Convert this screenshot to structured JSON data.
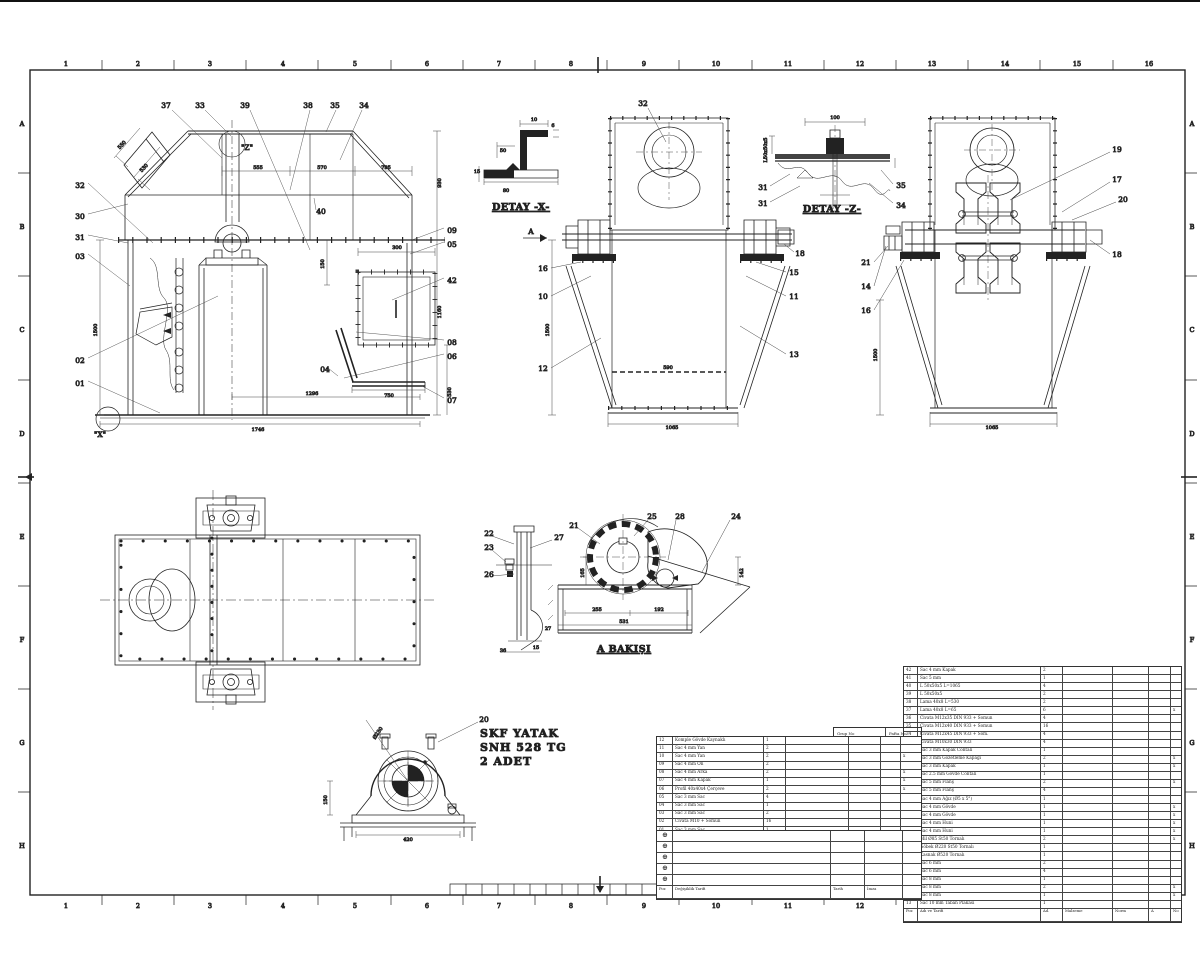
{
  "border": {
    "cols": [
      "1",
      "2",
      "3",
      "4",
      "5",
      "6",
      "7",
      "8",
      "9",
      "10",
      "11",
      "12",
      "13",
      "14",
      "15",
      "16"
    ],
    "rows": [
      "A",
      "B",
      "C",
      "D",
      "E",
      "F",
      "G",
      "H"
    ]
  },
  "titles": {
    "detay_x": "DETAY -X-",
    "detay_z": "DETAY -Z-",
    "a_bakisi": "A BAKIŞI",
    "label_z": "\"Z\"",
    "label_x": "\"X\"",
    "label_a": "A"
  },
  "callouts": {
    "front_top": [
      "37",
      "33",
      "39",
      "38",
      "35",
      "34"
    ],
    "front_left": [
      "32",
      "30",
      "31",
      "03",
      "02",
      "01"
    ],
    "front_right": [
      "09",
      "05",
      "42",
      "08",
      "06",
      "07"
    ],
    "front_mid": [
      "40",
      "04"
    ],
    "mid_view": [
      "32",
      "16",
      "10",
      "12",
      "15",
      "11",
      "13",
      "18"
    ],
    "right_view": [
      "19",
      "17",
      "20",
      "18",
      "21",
      "14",
      "16"
    ],
    "detay_z": [
      "31",
      "31",
      "35",
      "34"
    ],
    "a_bakisi": [
      "22",
      "23",
      "26",
      "27",
      "21",
      "25",
      "28",
      "24"
    ],
    "bearing": [
      "20"
    ]
  },
  "dims": {
    "front": {
      "w1": "555",
      "w2": "570",
      "w3": "795",
      "htop": "930",
      "hleft": "1500",
      "door": "300",
      "hright": "1160",
      "hboot": "530",
      "chute": "750",
      "base1": "1296",
      "base2": "1746",
      "inc1": "550",
      "inc2": "530",
      "v1": "150"
    },
    "mid": {
      "h": "1500",
      "inner": "590",
      "base": "1065"
    },
    "right": {
      "h": "1500",
      "base": "1065"
    },
    "detay_x": {
      "d1": "10",
      "d2": "6",
      "d3": "50",
      "d4": "15",
      "d5": "80"
    },
    "detay_z": {
      "d1": "100",
      "d2": "L50x50x5"
    },
    "a_bakisi": {
      "v1": "165",
      "v2": "142",
      "w1": "255",
      "w2": "192",
      "w3": "531",
      "s1": "27",
      "s2": "15",
      "s3": "36"
    },
    "bearing": {
      "h": "150",
      "w": "420",
      "dia": "Ø230"
    }
  },
  "bearing_note": {
    "l1": "SKF YATAK",
    "l2": "SNH 528 TG",
    "l3": "2 ADET"
  },
  "bom_right": {
    "header": [
      "Poz",
      "Adı ve Tarifi",
      "Ad.",
      "Malzeme",
      "Norm",
      "A",
      "No"
    ],
    "rows": [
      {
        "p": "42",
        "d": "Sac 4 mm Kapak",
        "q": "2",
        "n": ""
      },
      {
        "p": "41",
        "d": "Sac 5 mm",
        "q": "1",
        "n": ""
      },
      {
        "p": "40",
        "d": "L 50x50x5  L=1065",
        "q": "4",
        "n": ""
      },
      {
        "p": "39",
        "d": "L 50x50x5",
        "q": "2",
        "n": ""
      },
      {
        "p": "38",
        "d": "Lama 40x8  L=530",
        "q": "2",
        "n": ""
      },
      {
        "p": "37",
        "d": "Lama 40x8  L=65",
        "q": "6",
        "n": "x"
      },
      {
        "p": "36",
        "d": "Civata M12x35 DIN 933 + Somun",
        "q": "4",
        "n": ""
      },
      {
        "p": "35",
        "d": "Civata M12x40 DIN 933 + Somun",
        "q": "16",
        "n": ""
      },
      {
        "p": "34",
        "d": "Civata M12x45 DIN 933 + Som.",
        "q": "4",
        "n": ""
      },
      {
        "p": "33",
        "d": "Civata M10x30 DIN 933",
        "q": "4",
        "n": ""
      },
      {
        "p": "32",
        "d": "Sac 3 mm  Kapak Contalı",
        "q": "1",
        "n": ""
      },
      {
        "p": "31",
        "d": "Sac 3 mm  Gözetleme Kapağı",
        "q": "2",
        "n": "x"
      },
      {
        "p": "30",
        "d": "Sac 3 mm  Kapak",
        "q": "1",
        "n": "x"
      },
      {
        "p": "29",
        "d": "Sac 2.5 mm  Gövde Contalı",
        "q": "1",
        "n": ""
      },
      {
        "p": "28",
        "d": "Sac 5 mm  Flanş",
        "q": "2",
        "n": "x"
      },
      {
        "p": "27",
        "d": "Sac 5 mm  Flanş",
        "q": "4",
        "n": ""
      },
      {
        "p": "26",
        "d": "Sac 4 mm  Ağız  (Ø5 x 5°)",
        "q": "1",
        "n": ""
      },
      {
        "p": "25",
        "d": "Sac 4 mm  Gövde",
        "q": "1",
        "n": "x"
      },
      {
        "p": "24",
        "d": "Sac 4 mm  Gövde",
        "q": "1",
        "n": "x"
      },
      {
        "p": "23",
        "d": "Sac 4 mm  Huni",
        "q": "1",
        "n": "x"
      },
      {
        "p": "22",
        "d": "Sac 4 mm  Huni",
        "q": "1",
        "n": "x"
      },
      {
        "p": "21",
        "d": "Mil Ø85  St50  Tornalı",
        "q": "2",
        "n": "x"
      },
      {
        "p": "20",
        "d": "Göbek Ø220  St50  Tornalı",
        "q": "1",
        "n": ""
      },
      {
        "p": "19",
        "d": "Kasnak Ø520  Tornalı",
        "q": "1",
        "n": ""
      },
      {
        "p": "18",
        "d": "Sac 6 mm",
        "q": "2",
        "n": ""
      },
      {
        "p": "17",
        "d": "Sac 6 mm",
        "q": "4",
        "n": ""
      },
      {
        "p": "16",
        "d": "Sac 8 mm",
        "q": "1",
        "n": ""
      },
      {
        "p": "15",
        "d": "Sac 8 mm",
        "q": "2",
        "n": "x"
      },
      {
        "p": "14",
        "d": "Sac 8 mm",
        "q": "1",
        "n": "x"
      },
      {
        "p": "13",
        "d": "Sac 10 mm  Taban Plakası",
        "q": "1",
        "n": ""
      }
    ]
  },
  "bom_left": {
    "header": [
      "Poz",
      "Adı ve Tarifi",
      "Ölçüleri",
      "Malzeme",
      "Ad.",
      "Ağr.",
      "No"
    ],
    "rows": [
      {
        "p": "12",
        "d": "Komple Gövde  Kaynaklı",
        "q": "1",
        "n": ""
      },
      {
        "p": "11",
        "d": "Sac 4 mm  Yan",
        "q": "2",
        "n": ""
      },
      {
        "p": "10",
        "d": "Sac 4 mm  Yan",
        "q": "2",
        "n": "x"
      },
      {
        "p": "09",
        "d": "Sac 4 mm  Ön",
        "q": "2",
        "n": ""
      },
      {
        "p": "08",
        "d": "Sac 4 mm  Arka",
        "q": "2",
        "n": "x"
      },
      {
        "p": "07",
        "d": "Sac 4 mm  Kapak",
        "q": "1",
        "n": "x"
      },
      {
        "p": "06",
        "d": "Profil 40x40x4  Çerçeve",
        "q": "2",
        "n": "x"
      },
      {
        "p": "05",
        "d": "Sac 3 mm  Sac",
        "q": "4",
        "n": ""
      },
      {
        "p": "04",
        "d": "Sac 3 mm  Sac",
        "q": "1",
        "n": ""
      },
      {
        "p": "03",
        "d": "Sac 3 mm  Sac",
        "q": "2",
        "n": ""
      },
      {
        "p": "02",
        "d": "Civata M10 + Somun",
        "q": "16",
        "n": ""
      },
      {
        "p": "01",
        "d": "Sac 3 mm  Sac",
        "q": "1",
        "n": ""
      }
    ]
  },
  "rev": {
    "rows": [
      {
        "s": "⊕"
      },
      {
        "s": "⊕"
      },
      {
        "s": "⊕"
      },
      {
        "s": "⊕"
      },
      {
        "s": "⊕"
      }
    ],
    "footer": [
      "Poz",
      "Değişiklik Tarifi",
      "Tarih",
      "İmza"
    ]
  },
  "strip": {
    "c1": "Grup No",
    "c2": "Pafta No"
  }
}
